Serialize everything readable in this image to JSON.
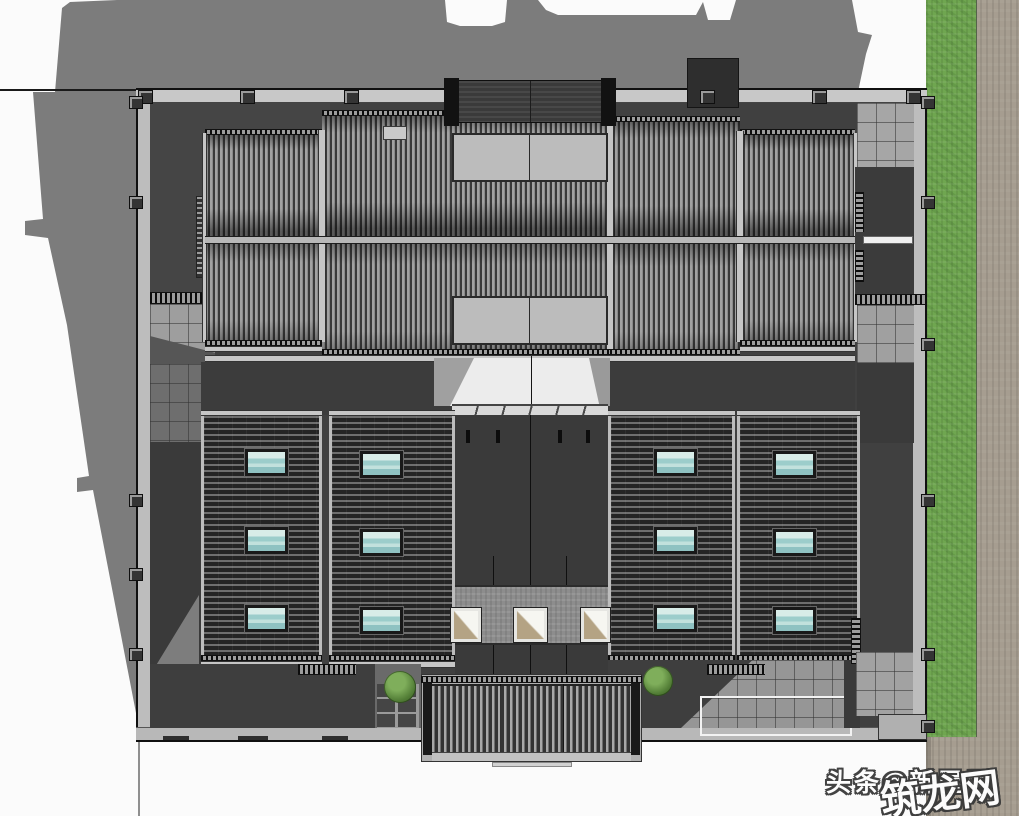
{
  "watermark": {
    "toutiao": "头条@新屋居",
    "zhulong": "筑龙网"
  },
  "palette": {
    "shadow": "#7c7c7c",
    "grass": "#6fa650",
    "road": "#a69d90",
    "flat_roof": "#3e3e3e",
    "ridged_roof_light": "#a2a2a2",
    "ridged_roof_dark": "#3a3a3a",
    "wall": "#c8c8c8",
    "courtyard_paving": "#9e9e9e",
    "ridge_cap": "#b8b8b8",
    "skylight_teal": "#9ccdcb",
    "light_well_tan": "#b4a384",
    "shrub_green": "#527d36"
  },
  "roof_windows": {
    "count": 12,
    "width": 43,
    "height": 27,
    "items": [
      {
        "x": 245,
        "y": 449
      },
      {
        "x": 245,
        "y": 527
      },
      {
        "x": 245,
        "y": 605
      },
      {
        "x": 360,
        "y": 451
      },
      {
        "x": 360,
        "y": 529
      },
      {
        "x": 360,
        "y": 607
      },
      {
        "x": 654,
        "y": 449
      },
      {
        "x": 654,
        "y": 527
      },
      {
        "x": 654,
        "y": 605
      },
      {
        "x": 773,
        "y": 451
      },
      {
        "x": 773,
        "y": 529
      },
      {
        "x": 773,
        "y": 607
      }
    ]
  },
  "light_wells": {
    "count": 3,
    "items": [
      {
        "x": 451,
        "y": 608,
        "w": 30,
        "h": 34
      },
      {
        "x": 514,
        "y": 608,
        "w": 33,
        "h": 34
      },
      {
        "x": 581,
        "y": 608,
        "w": 29,
        "h": 34
      }
    ]
  },
  "shrubs": [
    {
      "x": 384,
      "y": 671,
      "d": 32
    },
    {
      "x": 643,
      "y": 666,
      "d": 30
    }
  ],
  "pilasters": {
    "north_x": [
      138,
      240,
      344,
      700,
      812,
      906
    ],
    "west_y": [
      96,
      196,
      494,
      568,
      648
    ],
    "east_y": [
      96,
      196,
      338,
      494,
      648,
      720
    ]
  },
  "south_doors": [
    {
      "x": 163,
      "w": 26
    },
    {
      "x": 238,
      "w": 30
    },
    {
      "x": 322,
      "w": 26
    }
  ],
  "canopy_posts": [
    466,
    496,
    558,
    586
  ]
}
